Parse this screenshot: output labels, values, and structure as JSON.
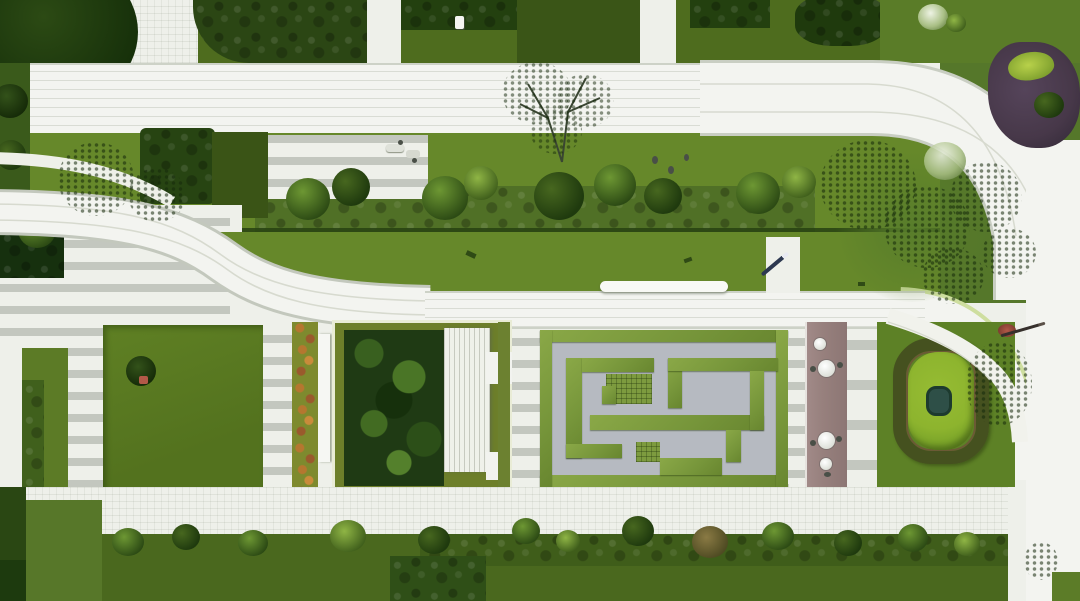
{
  "meta": {
    "title": "Aerial top-down rendering of a residential landscape masterplan",
    "render_type": "photorealistic site plan",
    "canvas": {
      "width": 1080,
      "height": 601
    }
  },
  "palette": {
    "paving": "#eef0ea",
    "paving-bright": "#f3f4f0",
    "stripe": "#c3c7bf",
    "road-edge": "#cdd2c7",
    "lawn": "#66882a",
    "lawn-dark": "#4e6c1e",
    "lawn-deep": "#3a5517",
    "tree-dark": "#23400f",
    "hedge-band": "#507026",
    "hedge-line": "#274112",
    "maze-path": "#b6bac1",
    "maze-hedge": "#7f9e41",
    "garden-bed": "#1f3a14",
    "flower-orange": "#b5772f",
    "flower-rust": "#9a5a2c",
    "deck-mauve": "#97807d",
    "mound-green": "#8db42e",
    "mound-ring": "#45511f",
    "pond-teal": "#2e4f47",
    "pale-tree": "#d4e0c6",
    "purple-bed": "#473849",
    "accent-red": "#b25948",
    "pen-navy": "#2c3850",
    "bottom-hedge": "#4a681e"
  },
  "regions": {
    "upper_road": {
      "label": "Upper pedestrian road curving down the right side"
    },
    "top_lawns": {
      "label": "Top lawn panels with dark tree canopies and white walkways"
    },
    "shrub_border": {
      "label": "Mixed shrub border hedge along the upper lawns"
    },
    "s_curve_path": {
      "label": "S-shaped white promenade path"
    },
    "striped_plaza": {
      "label": "Striped paved plaza with dark planter box"
    },
    "lawn_square": {
      "label": "Square lawn panel with single specimen tree"
    },
    "flower_border": {
      "label": "Orange flowering border strip"
    },
    "sunken_garden": {
      "label": "Sunken rainforest garden with white pergola deck"
    },
    "hedge_maze": {
      "label": "Clipped hedge maze garden"
    },
    "timber_deck": {
      "label": "Mauve timber deck with cafe tables and chairs"
    },
    "spiral_mound": {
      "label": "Spiral lawn mound with central pond"
    },
    "feature_tree": {
      "label": "Pale-foliage feature tree beside the mound"
    },
    "central_road": {
      "label": "Central white road with bench and side path"
    },
    "perimeter_road": {
      "label": "Perimeter road along the right edge"
    },
    "tree_cluster": {
      "label": "Large dark tree cluster inside the road curve"
    },
    "purple_bed": {
      "label": "Purple foliage planting bed at top right"
    },
    "blossom_tree": {
      "label": "Delicate blossom tree over the upper road"
    },
    "bottom_hedge": {
      "label": "Bottom shrub and hedge planting band"
    },
    "bench": {
      "label": "White linear bench beside central road"
    },
    "pen_marker": {
      "label": "Dark stylus/pen resting on the model"
    },
    "cafe_tables": {
      "label": "Round white cafe tables with chairs"
    }
  }
}
